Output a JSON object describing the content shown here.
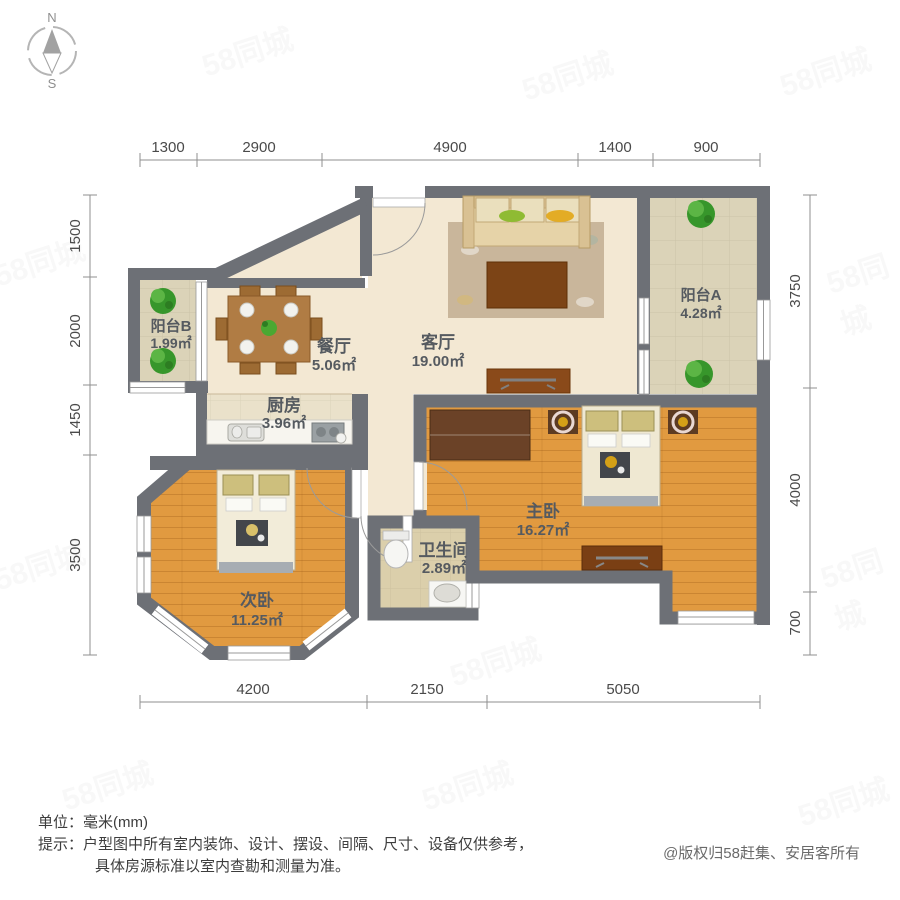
{
  "compass": {
    "north": "N",
    "south": "S"
  },
  "dimensions": {
    "top": [
      "1300",
      "2900",
      "4900",
      "1400",
      "900"
    ],
    "left": [
      "1500",
      "2000",
      "1450",
      "3500"
    ],
    "right": [
      "3750",
      "4000",
      "700"
    ],
    "bottom": [
      "4200",
      "2150",
      "5050"
    ]
  },
  "rooms": [
    {
      "id": "balcony-b",
      "name": "阳台B",
      "area": "1.99㎡"
    },
    {
      "id": "dining",
      "name": "餐厅",
      "area": "5.06㎡"
    },
    {
      "id": "living",
      "name": "客厅",
      "area": "19.00㎡"
    },
    {
      "id": "balcony-a",
      "name": "阳台A",
      "area": "4.28㎡"
    },
    {
      "id": "kitchen",
      "name": "厨房",
      "area": "3.96㎡"
    },
    {
      "id": "second-bedroom",
      "name": "次卧",
      "area": "11.25㎡"
    },
    {
      "id": "bathroom",
      "name": "卫生间",
      "area": "2.89㎡"
    },
    {
      "id": "master-bedroom",
      "name": "主卧",
      "area": "16.27㎡"
    }
  ],
  "footer": {
    "unit_label": "单位：",
    "unit_value": "毫米(mm)",
    "tip_label": "提示：",
    "tip_line1": "户型图中所有室内装饰、设计、摆设、间隔、尺寸、设备仅供参考，",
    "tip_line2": "具体房源标准以室内查勘和测量为准。",
    "copyright": "@版权归58赶集、安居客所有"
  },
  "watermark": {
    "text": "58同城"
  },
  "colors": {
    "wall": "#6d7076",
    "wood_floor": "#e19a40",
    "cream_floor": "#f3e8d3",
    "tile_floor": "#dbd3b8",
    "accent_green": "#8fbb33",
    "accent_yellow": "#e3ac25"
  }
}
